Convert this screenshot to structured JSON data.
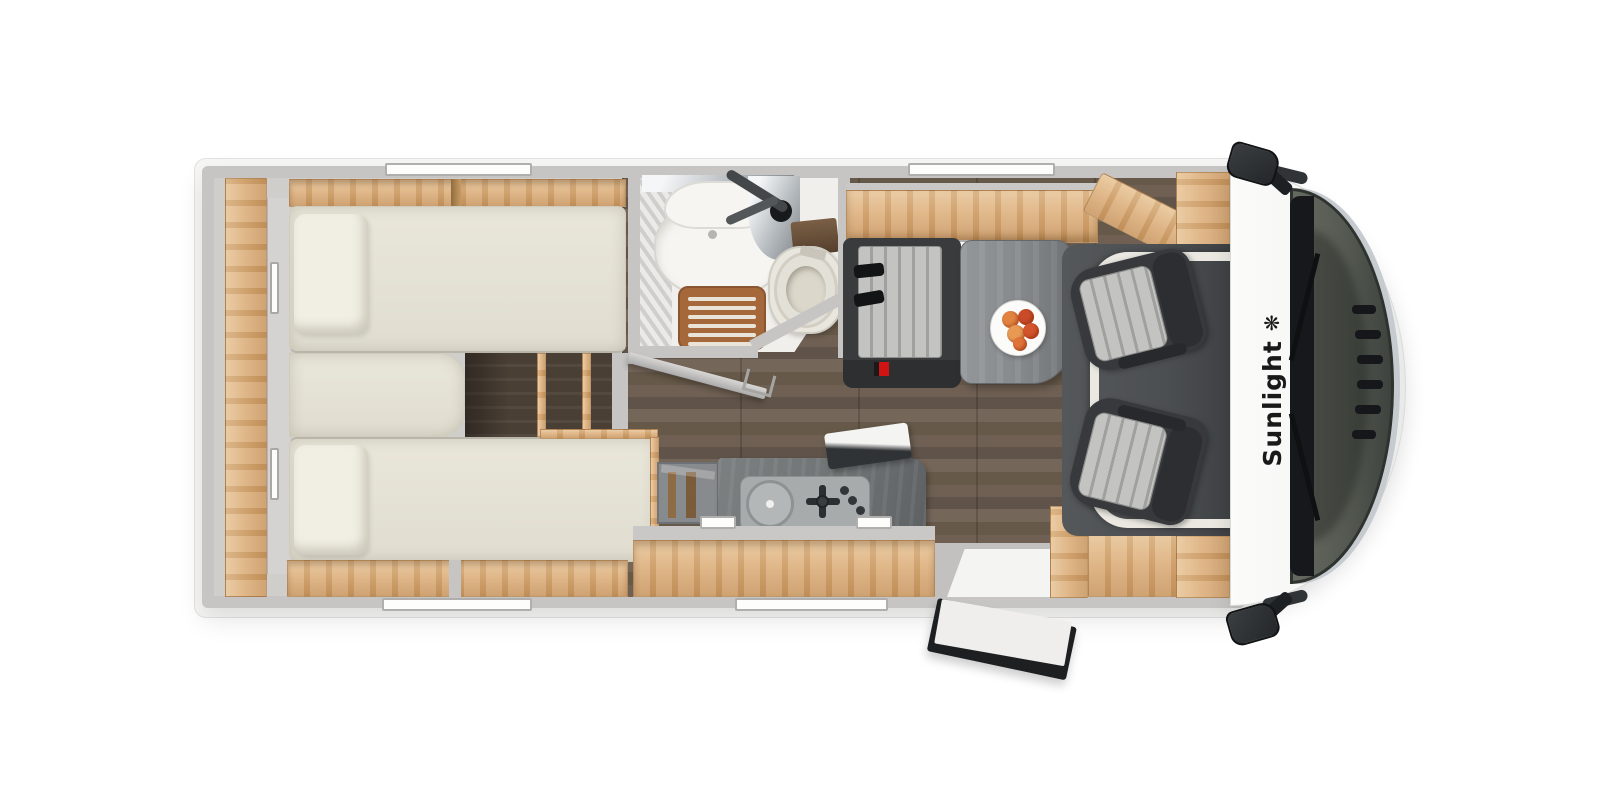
{
  "brand": {
    "name": "Sunlight",
    "logo_glyph": "❋"
  },
  "colors": {
    "wall": "#c6c5c3",
    "wood": "#dcae7a",
    "wood_dark": "#c3935f",
    "floor": "#6a5b4e",
    "steps": "#4a3f35",
    "mattress": "#e9e6da",
    "pillow": "#f1eee4",
    "bench_dark": "#3a3b3d",
    "fabric": "#c3c4c2",
    "fabric_stripe": "#a0a19f",
    "table": "#85898b",
    "counter": "#a8abab",
    "kitchen_block": "#6f7374",
    "teak": "#a4683a",
    "bath_floor": "#f0efeb",
    "fixture": "#f6f5f2",
    "toilet": "#e9e6de",
    "cab_floor": "#4c4f51",
    "cab_frame": "#eae8e1",
    "glass": "#545951",
    "cowl": "#16181b",
    "chrome": "#c6cbcf",
    "body_white": "#fbfbfa",
    "mirror": "#24272a",
    "red": "#d01414",
    "fruit_orange": "#e2823f",
    "fruit_red": "#c94b28",
    "logo": "#191919"
  }
}
